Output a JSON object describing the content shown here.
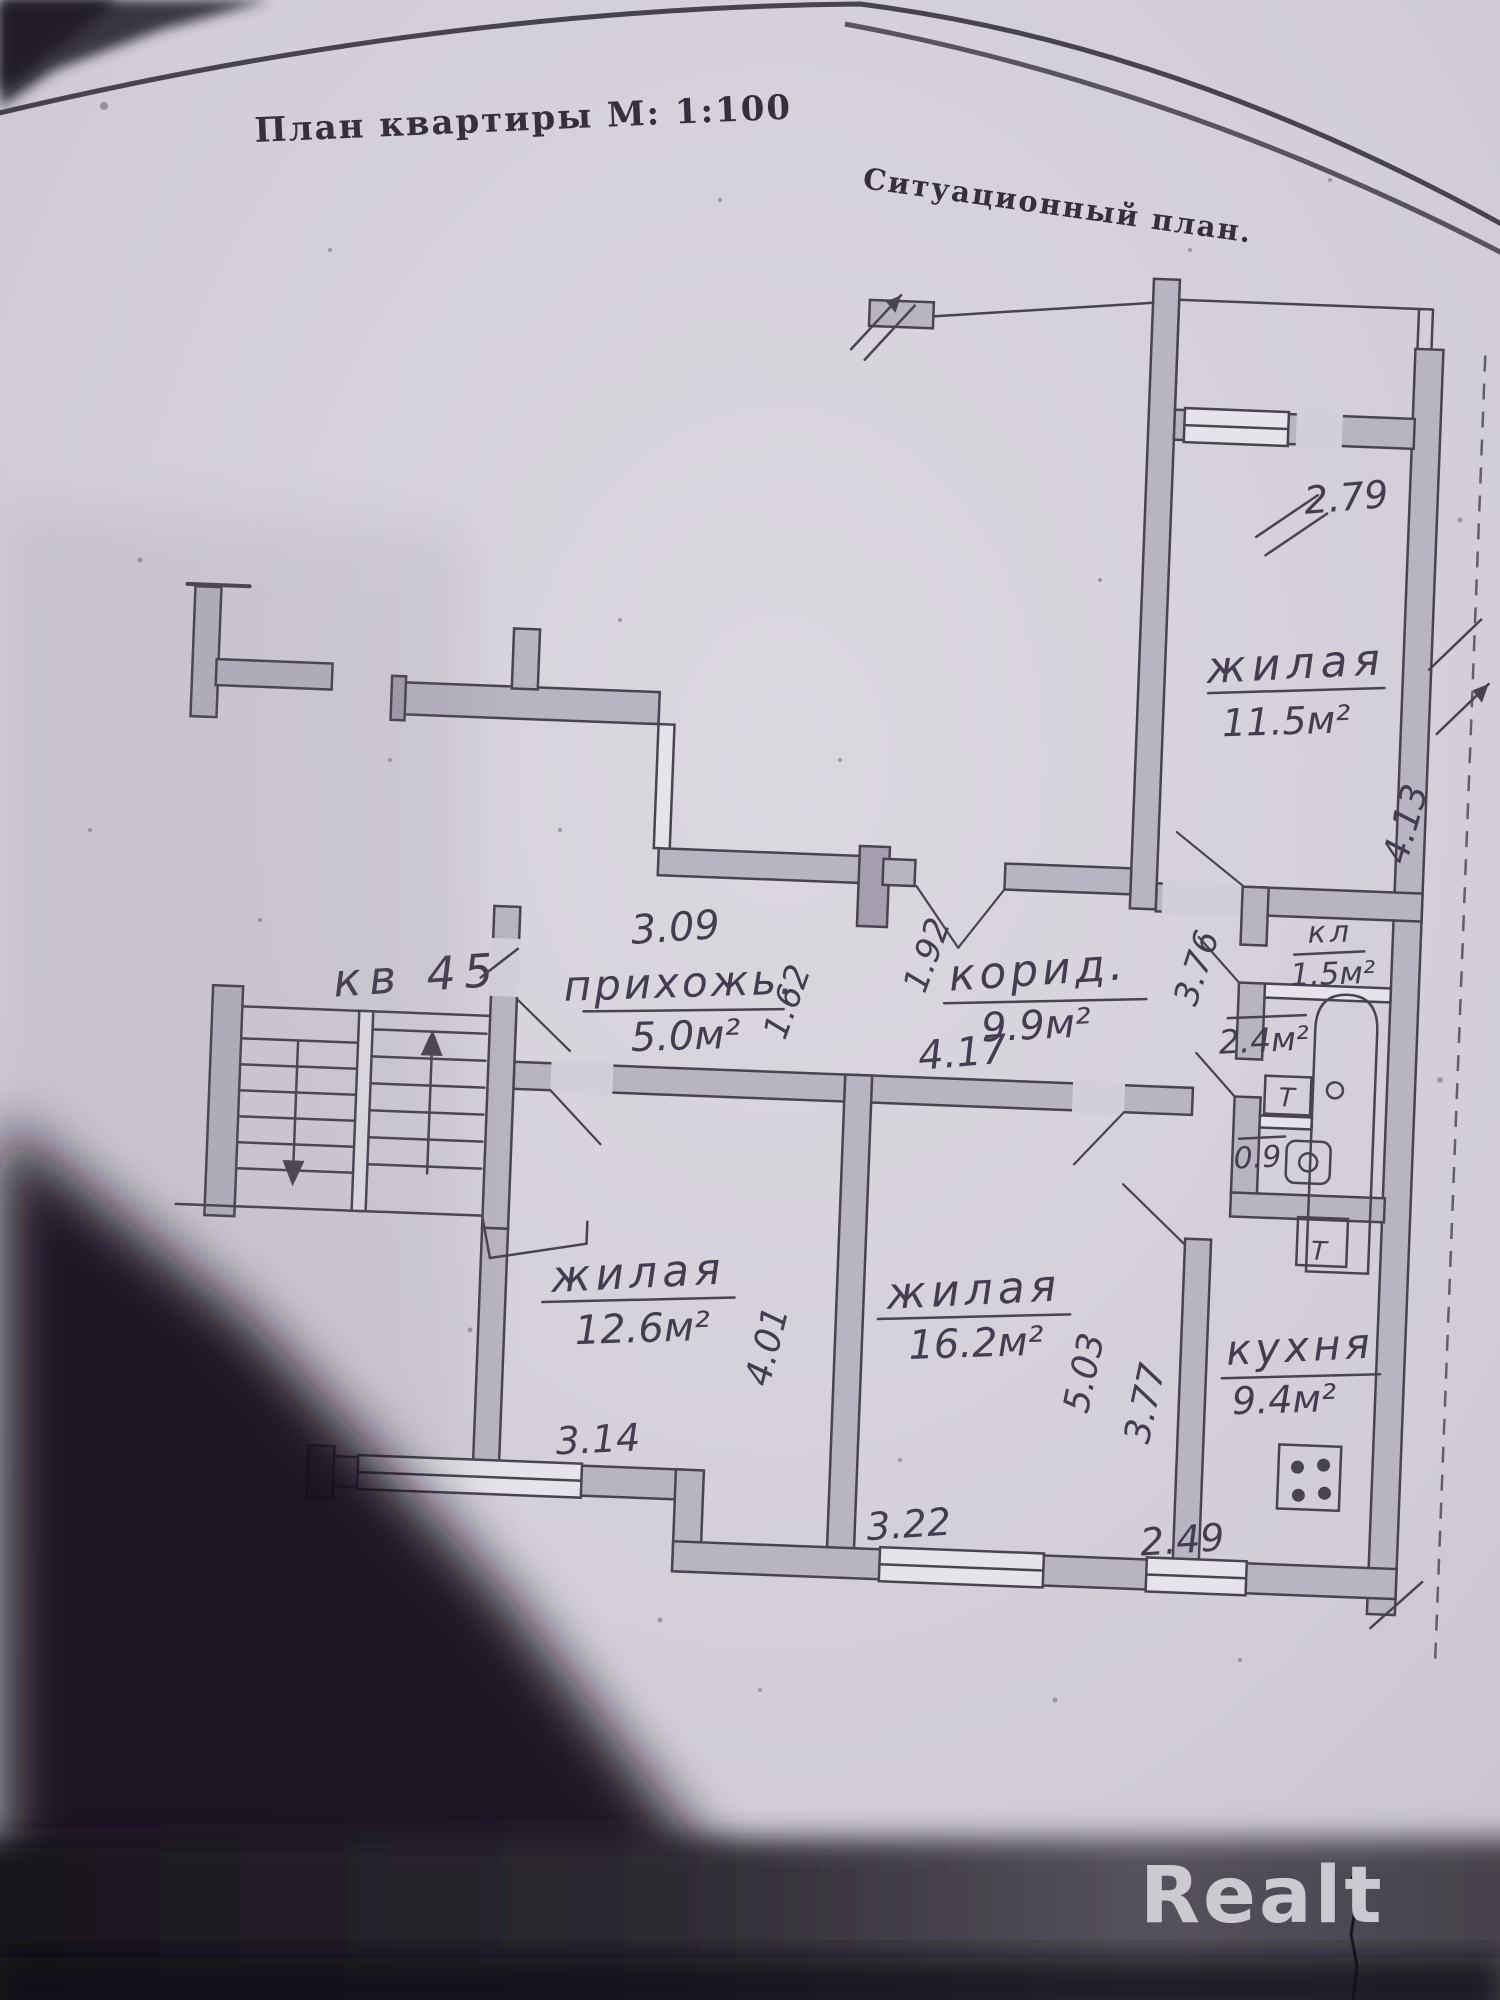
{
  "document": {
    "title": "План квартиры  М: 1:100",
    "subtitle": "Ситуационный план.",
    "watermark": "Realt"
  },
  "plan": {
    "apartment_label": "кв 45",
    "rooms": [
      {
        "id": "living-11-5",
        "name": "жилая",
        "area": "11.5м²"
      },
      {
        "id": "closet",
        "name": "кл",
        "area": "1.5м²"
      },
      {
        "id": "corridor",
        "name": "корид.",
        "area": "9.9м²"
      },
      {
        "id": "hallway",
        "name": "прихожь.",
        "area": "5.0м²"
      },
      {
        "id": "living-12-6",
        "name": "жилая",
        "area": "12.6м²"
      },
      {
        "id": "living-16-2",
        "name": "жилая",
        "area": "16.2м²"
      },
      {
        "id": "kitchen",
        "name": "кухня",
        "area": "9.4м²"
      },
      {
        "id": "bathroom",
        "name": "",
        "area": "2.4м²"
      },
      {
        "id": "wc",
        "name": "",
        "area": "0.9"
      }
    ],
    "dimensions": {
      "balcony_width": "2.79",
      "living11_depth": "4.13",
      "sanblock_height": "3.76",
      "corridor_width": "1.92",
      "corridor_length": "4.17",
      "hall_width": "3.09",
      "hall_depth": "1.62",
      "room12_width": "3.14",
      "room12_depth": "4.01",
      "room16_depth": "5.03",
      "kitchen_depth": "3.77",
      "room16_width": "3.22",
      "kitchen_width": "2.49"
    },
    "fixtures": {
      "tap_mark": "Т"
    }
  },
  "colors": {
    "paper": "#d3cfd8",
    "ink": "#4a4450",
    "wall_fill": "#b9b4c1",
    "shadow": "#14111a",
    "watermark": "#ccc9d0"
  }
}
